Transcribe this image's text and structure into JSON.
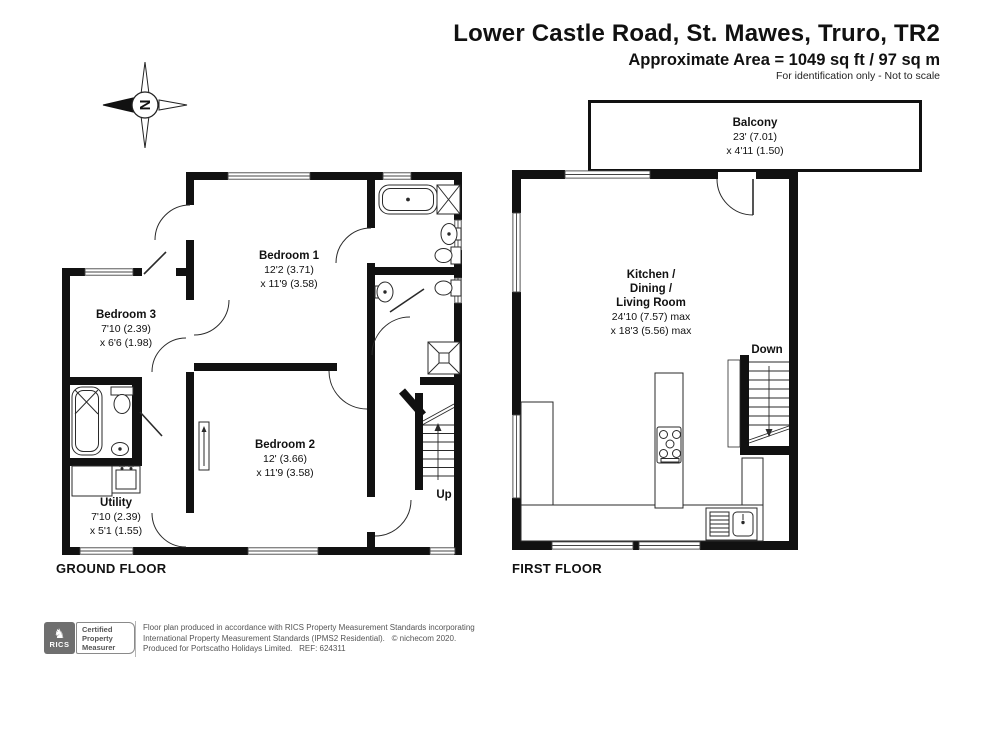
{
  "header": {
    "title": "Lower Castle Road, St. Mawes, Truro, TR2",
    "area": "Approximate Area = 1049 sq ft / 97 sq m",
    "note": "For identification only - Not to scale"
  },
  "compass": {
    "letter": "N"
  },
  "floors": {
    "ground": {
      "label": "GROUND FLOOR"
    },
    "first": {
      "label": "FIRST FLOOR"
    }
  },
  "rooms": {
    "bedroom1": {
      "name": "Bedroom 1",
      "d1": "12'2 (3.71)",
      "d2": "x 11'9 (3.58)"
    },
    "bedroom2": {
      "name": "Bedroom 2",
      "d1": "12' (3.66)",
      "d2": "x 11'9 (3.58)"
    },
    "bedroom3": {
      "name": "Bedroom 3",
      "d1": "7'10 (2.39)",
      "d2": "x 6'6 (1.98)"
    },
    "utility": {
      "name": "Utility",
      "d1": "7'10 (2.39)",
      "d2": "x 5'1 (1.55)"
    },
    "kitchen": {
      "n1": "Kitchen /",
      "n2": "Dining /",
      "n3": "Living Room",
      "d1": "24'10 (7.57) max",
      "d2": "x 18'3 (5.56) max"
    },
    "balcony": {
      "name": "Balcony",
      "d1": "23' (7.01)",
      "d2": "x 4'11 (1.50)"
    }
  },
  "stairs": {
    "up": "Up",
    "down": "Down"
  },
  "footer": {
    "brand": "RICS",
    "cert1": "Certified",
    "cert2": "Property",
    "cert3": "Measurer",
    "line1": "Floor plan produced in accordance with RICS Property Measurement Standards incorporating",
    "line2": "International Property Measurement Standards (IPMS2 Residential).   © nichecom 2020.",
    "line3": "Produced for Portscatho Holidays Limited.   REF: 624311"
  },
  "colors": {
    "wall": "#111111",
    "line": "#2a2a2a",
    "window": "#444444"
  }
}
